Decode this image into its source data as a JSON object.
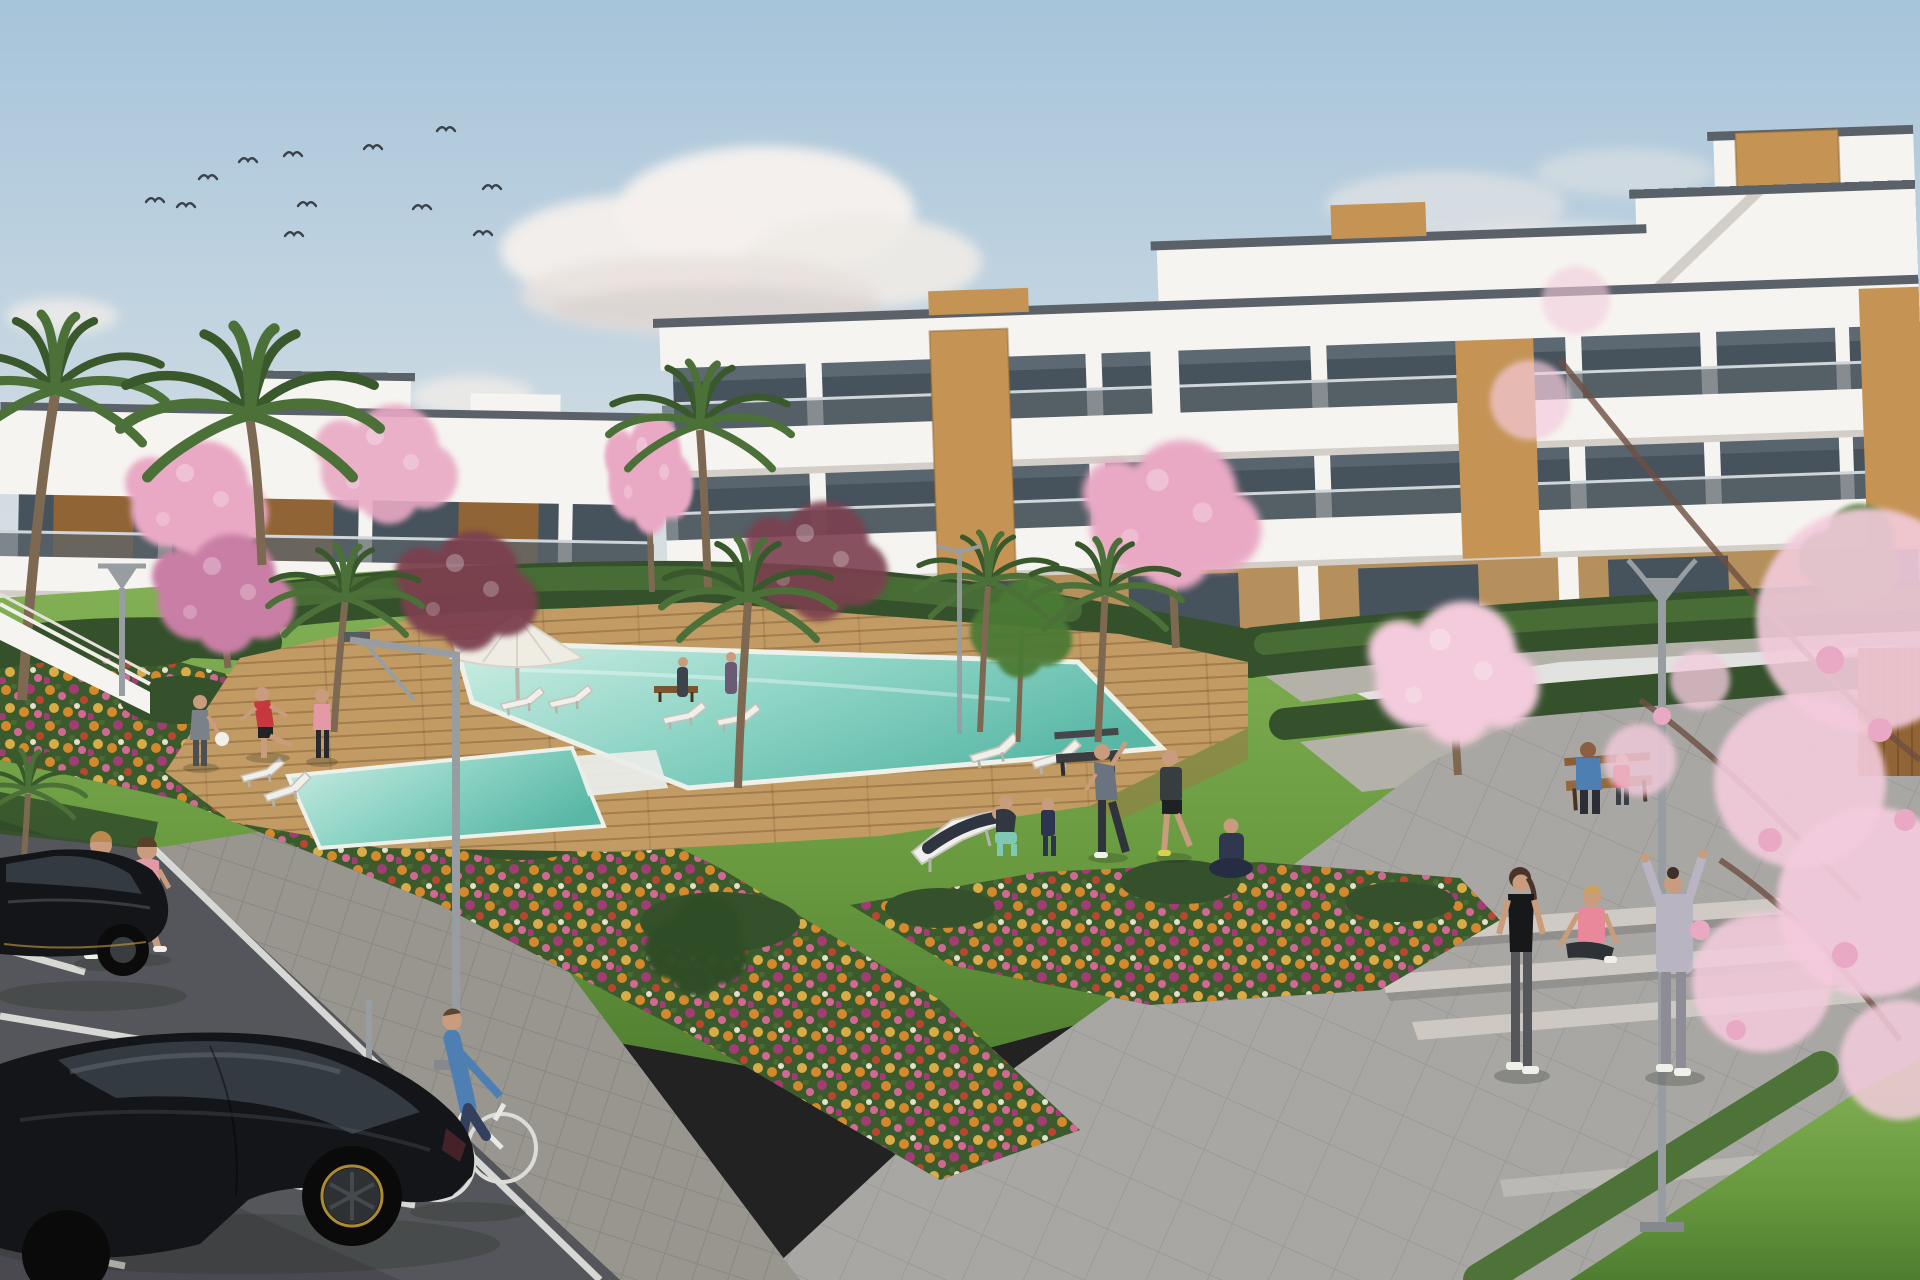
{
  "image": {
    "type": "3d-architectural-rendering",
    "setting": "New-build white apartment complex with communal pool, timber deck, flower gardens, lawn with residents exercising, parking with black cars and a cyclist",
    "time_of_day": "sunny daytime",
    "width_px": 1920,
    "height_px": 1280
  },
  "palette": {
    "sky_top": "#a6c4da",
    "sky_mid": "#c9d8e2",
    "sky_horizon": "#e6e5e0",
    "cloud_white": "#f3efeb",
    "cloud_shadow": "#d8d2cf",
    "bird": "#3a4148",
    "building_white": "#f6f4f0",
    "building_shade": "#e8e4dd",
    "slab_edge": "#d3cfc8",
    "roof_line": "#5b6168",
    "glass": "#46525c",
    "glass_light": "#72808a",
    "balcony_glass": "#5a646b",
    "wood": "#c59455",
    "wood_dark": "#916436",
    "ground_wall": "#b5905c",
    "hedge_dark": "#34512b",
    "hedge_light": "#4d7338",
    "lawn_light": "#84b156",
    "lawn": "#68993f",
    "lawn_dark": "#4e7d30",
    "deck": "#c29b64",
    "deck_dark": "#9e7646",
    "pool_light": "#cfeee4",
    "pool_mid": "#8fd5c6",
    "pool_deep": "#59b7a5",
    "pool_rim": "#eef0ea",
    "flower_bed": "#3c5b2c",
    "flower_orange": "#dd8b2d",
    "flower_pink": "#da6a9a",
    "flower_magenta": "#a83a78",
    "flower_red": "#c04530",
    "flower_gold": "#e2b04a",
    "path": "#b4b1a9",
    "plaza": "#a9a7a3",
    "step_light": "#c7c4bf",
    "step_shadow": "#807e7b",
    "sidewalk": "#98968f",
    "road": "#55565b",
    "road_dark": "#3f4045",
    "line_white": "#e3e3df",
    "car_black": "#141519",
    "car_glass": "#333a41",
    "car_highlight": "#596066",
    "rim_yellow": "#c9a23a",
    "trunk": "#7d6852",
    "palm_green": "#4b7038",
    "palm_dark": "#39582c",
    "blossom": "#e9a9c4",
    "blossom_light": "#f3cbdc",
    "blossom_dark": "#c97fa5",
    "maroon_tree": "#7b4150",
    "green_tree": "#4c7a35",
    "green_tree_dark": "#2f4d26",
    "lamp_gray": "#989da1",
    "teal_top": "#8ed1bd",
    "pink_top": "#e39aa6",
    "red_top": "#c6383d",
    "blue_shirt": "#4d7fb2",
    "denim": "#33415e",
    "gray_hoodie": "#b9b4c2",
    "coral_top": "#e8889a",
    "skin": "#c89c7c"
  },
  "scene": {
    "sky": {
      "birds": 12,
      "clouds": [
        "large cumulus centre-left",
        "wisps top-right",
        "small puff lower-left"
      ]
    },
    "buildings": {
      "left_block": {
        "floors": 2,
        "style": "white render, timber cladding panels, glass balustrades"
      },
      "right_block": {
        "floors": 4,
        "style": "stepped white volumes, ribbon glazing, timber feature piers, rooftop timber boxes, external stair"
      }
    },
    "pool": {
      "water": "turquoise gradient",
      "deck": "timber planks",
      "features": [
        "white corner steps",
        "side lane"
      ]
    },
    "furniture": {
      "sun_loungers": 9,
      "parasols": 1,
      "benches": 3,
      "street_lamps": 5
    },
    "vegetation": {
      "palms": 8,
      "cherry_blossom_trees": 7,
      "maroon_trees": 2,
      "green_trees": 3,
      "hedges": "clipped dark green bands",
      "flower_beds": "orange / pink / magenta / red drifts",
      "foreground": "pink blossom branches overhanging right edge"
    },
    "people": [
      {
        "role": "jogger",
        "top": "mint",
        "bottom": "black shorts",
        "where": "left sidewalk"
      },
      {
        "role": "jogger",
        "top": "pink",
        "bottom": "grey capri",
        "where": "left sidewalk"
      },
      {
        "role": "man holding white ball",
        "top": "grey",
        "where": "pool deck"
      },
      {
        "role": "man stretching leg",
        "top": "red",
        "bottom": "black shorts",
        "where": "pool deck"
      },
      {
        "role": "woman jogging",
        "top": "pink",
        "bottom": "black leggings",
        "where": "pool deck"
      },
      {
        "role": "person reclining on lounger",
        "clothes": "dark",
        "where": "lawn"
      },
      {
        "role": "woman crouching",
        "bottom": "teal leggings",
        "where": "lawn"
      },
      {
        "role": "child in dark tracksuit",
        "where": "lawn"
      },
      {
        "role": "man side-stretch arm raised",
        "top": "grey",
        "where": "lawn"
      },
      {
        "role": "man stretching",
        "top": "black",
        "bottom": "grey shorts",
        "where": "lawn"
      },
      {
        "role": "person seated cross-legged",
        "clothes": "navy",
        "where": "lawn"
      },
      {
        "role": "woman standing",
        "top": "black vest",
        "bottom": "light leggings",
        "where": "steps"
      },
      {
        "role": "woman seated on step",
        "top": "coral vest",
        "where": "steps"
      },
      {
        "role": "woman arms raised",
        "top": "lilac-grey hoodie",
        "where": "plaza"
      },
      {
        "role": "man seated on bench",
        "top": "blue",
        "where": "right path"
      },
      {
        "role": "child seated on bench",
        "top": "red",
        "where": "right path"
      },
      {
        "role": "resident walking",
        "where": "building walkway"
      },
      {
        "role": "resident walking with bag",
        "where": "building walkway"
      }
    ],
    "vehicles": {
      "parked_cars": 2,
      "car_color": "black with yellow rim accents",
      "bicycle": {
        "frame": "white",
        "rider_top": "blue",
        "rider_bottom": "dark jeans"
      }
    },
    "ground": {
      "parking": "dark asphalt with white bays",
      "paths": "light concrete pavers",
      "steps": "wide stone steps lower right with diagonal hedge"
    }
  }
}
